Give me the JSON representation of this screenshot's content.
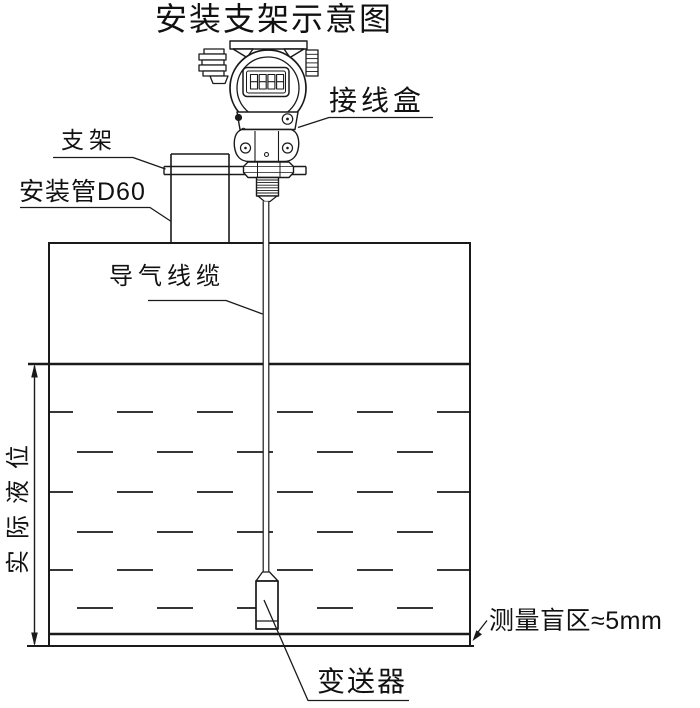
{
  "title": "安装支架示意图",
  "labels": {
    "junction_box": "接线盒",
    "bracket": "支架",
    "mounting_pipe": "安装管D60",
    "air_cable": "导气线缆",
    "actual_liquid_level": "实际液位",
    "blind_zone": "测量盲区≈5mm",
    "transmitter": "变送器"
  },
  "icons": {
    "lcd_display": "8888-segment-display",
    "dimension_arrow": "double-headed-vertical-arrow"
  },
  "colors": {
    "background": "#ffffff",
    "line": "#1a1a1a",
    "text": "#111111"
  }
}
